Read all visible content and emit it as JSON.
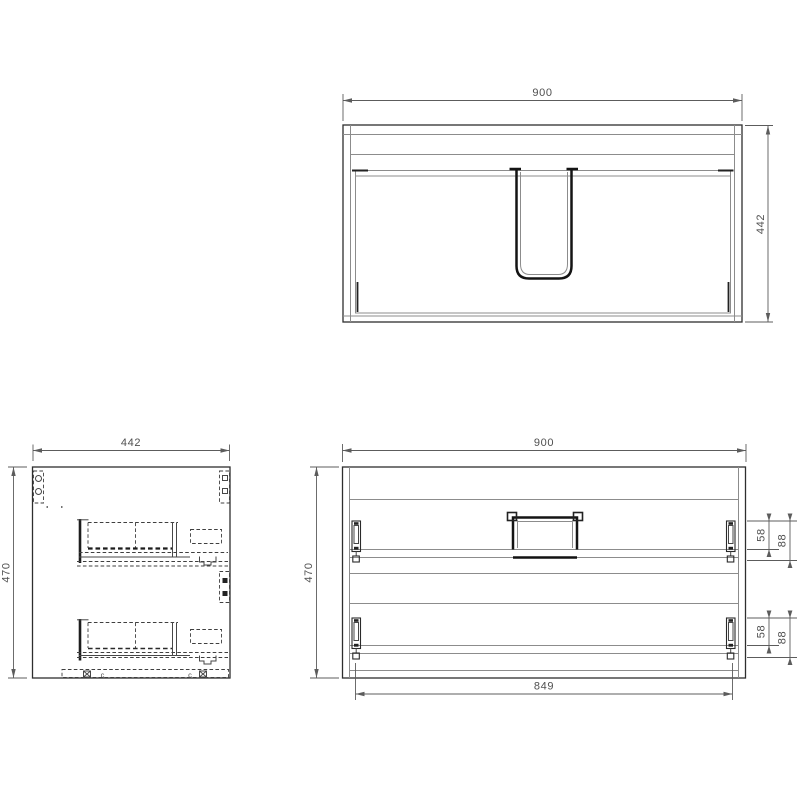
{
  "drawing": {
    "background": "#ffffff",
    "line_colors": {
      "object": "#2e2e2e",
      "secondary": "#8c8c8c",
      "hidden": "#3f3f3f",
      "dimension": "#5c5c5c",
      "text": "#4f4f4f"
    },
    "views": {
      "plan": {
        "name": "plan-view-top",
        "dims": {
          "width": "900",
          "depth": "442"
        }
      },
      "side": {
        "name": "side-view",
        "dims": {
          "width": "442",
          "height": "470"
        },
        "labels": {
          "clip_left": "c",
          "clip_right": "c"
        }
      },
      "front": {
        "name": "front-elevation",
        "dims": {
          "width": "900",
          "height": "470",
          "inner_width": "849",
          "upper_rail_inner": "58",
          "upper_rail_outer": "88",
          "lower_rail_inner": "58",
          "lower_rail_outer": "88"
        }
      }
    }
  }
}
